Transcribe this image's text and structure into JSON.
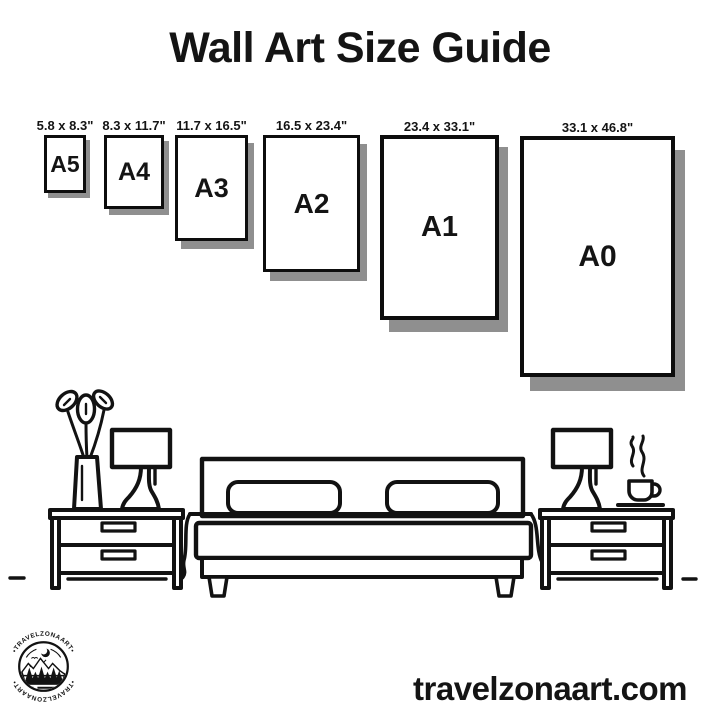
{
  "title": "Wall Art Size Guide",
  "size_guide": {
    "frames": [
      {
        "label": "A5",
        "dimensions": "5.8 x 8.3\""
      },
      {
        "label": "A4",
        "dimensions": "8.3 x 11.7\""
      },
      {
        "label": "A3",
        "dimensions": "11.7 x 16.5\""
      },
      {
        "label": "A2",
        "dimensions": "16.5 x 23.4\""
      },
      {
        "label": "A1",
        "dimensions": "23.4 x 33.1\""
      },
      {
        "label": "A0",
        "dimensions": "33.1 x 46.8\""
      }
    ]
  },
  "logo": {
    "brand": "TRAVELZONAART",
    "arc_text_top": "•TRAVELZONAART•",
    "arc_text_bottom": "•TRAVELZONAART•"
  },
  "footer": {
    "website": "travelzonaart.com"
  },
  "colors": {
    "ink": "#121212",
    "shadow": "#8f8f8f",
    "background": "#ffffff"
  }
}
